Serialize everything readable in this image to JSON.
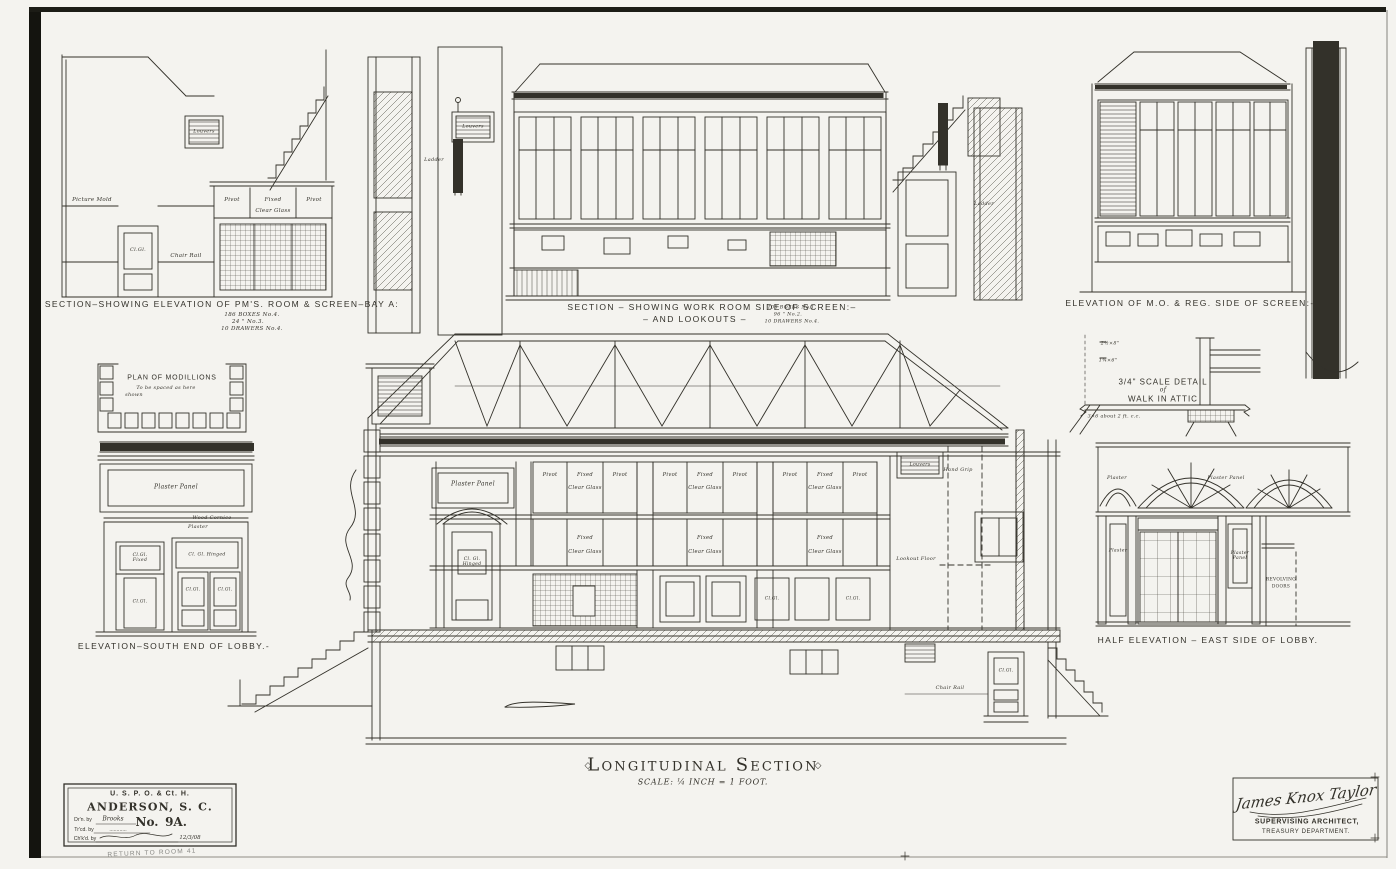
{
  "page": {
    "paper": "#f4f3ef",
    "ink": "#33312a"
  },
  "panels": {
    "pms": {
      "title": "SECTION–SHOWING ELEVATION OF PM'S. ROOM & SCREEN–BAY A:",
      "notes": [
        "186 BOXES  No.4.",
        "24      \"      No.3.",
        "10 DRAWERS No.4."
      ]
    },
    "workroom": {
      "title": "SECTION – SHOWING WORK ROOM SIDE OF SCREEN:–",
      "subtitle": "– AND LOOKOUTS –",
      "notes": [
        "108 BOXES No.1.",
        "96      \"      No.2.",
        "10 DRAWERS No.4."
      ]
    },
    "moreg": {
      "title": "ELEVATION OF M.O. & REG. SIDE OF SCREEN:-"
    },
    "attic": {
      "line1": "3/4\" SCALE DETAIL",
      "line2": "of",
      "line3": "WALK IN ATTIC",
      "dim1": "2½×8\"",
      "dim2": "1¾×6\"",
      "note": "3×6 about 2 ft. c.c."
    },
    "modillions": {
      "line1": "PLAN OF MODILLIONS",
      "line2": "To be spaced as here",
      "line3": "shown"
    },
    "south_lobby": {
      "title": "ELEVATION–SOUTH END OF LOBBY.-"
    },
    "east_lobby": {
      "title": "HALF ELEVATION – EAST SIDE OF LOBBY.",
      "revolving1": "REVOLVING",
      "revolving2": "DOORS"
    },
    "main": {
      "title": "Longitudinal Section",
      "ornament": "◇",
      "scale": "SCALE: ¼ INCH = 1 FOOT."
    }
  },
  "labels": {
    "pivot": "Pivot",
    "fixed": "Fixed",
    "clear_glass": "Clear Glass",
    "cl_gl": "Cl.Gl.",
    "cl_gl_hinged": "Cl. Gl. Hinged",
    "cl_gl_fixed": "Cl.Gl. Fixed",
    "plaster_panel": "Plaster Panel",
    "plaster": "Plaster",
    "wood_cornice": "Wood Cornice",
    "picture_mold": "Picture Mold",
    "chair_rail": "Chair Rail",
    "louvers": "Louvers",
    "ladder": "Ladder",
    "hand_grip": "Hand Grip",
    "lookout_floor": "Lookout Floor"
  },
  "title_block": {
    "agency": "U. S. P. O. & Ct. H.",
    "city": "ANDERSON, S. C.",
    "drawn_label": "Dr'n. by",
    "drawn_value": "Brooks",
    "no_label": "No.",
    "no_value": "9A.",
    "traced_label": "Tr'cd. by",
    "traced_value": "............",
    "checked_label": "Ch'k'd. by",
    "checked_value": "12/3/08",
    "stamp": "RETURN TO ROOM 41"
  },
  "signature": {
    "script": "James Knox Taylor",
    "role": "SUPERVISING ARCHITECT,",
    "dept": "TREASURY DEPARTMENT."
  }
}
